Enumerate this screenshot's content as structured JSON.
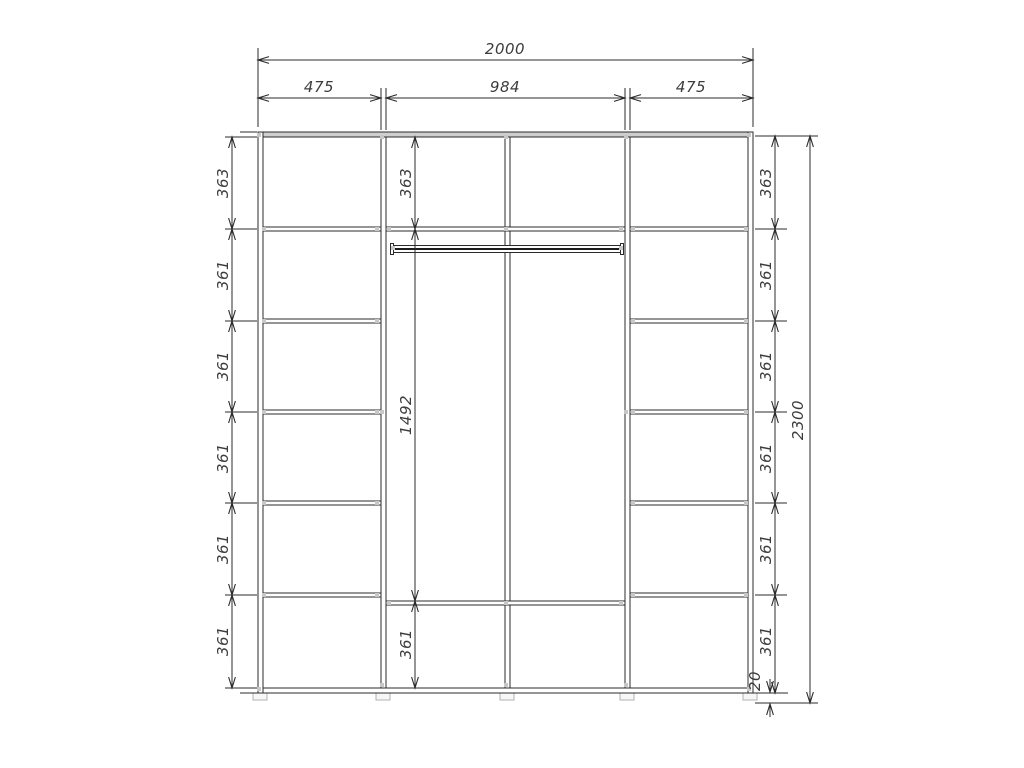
{
  "drawing": {
    "kind": "wardrobe-interior-dimension-drawing"
  },
  "colors": {
    "line": "#2b2b2b",
    "label": "#3c3c3c",
    "handle": "#c7c7c7",
    "top_panel_shade": "#cfcfcf",
    "background": "#ffffff"
  },
  "dimensions": {
    "overall_width": "2000",
    "top_sections": [
      "475",
      "984",
      "475"
    ],
    "left_column": [
      "363",
      "361",
      "361",
      "361",
      "361",
      "361"
    ],
    "center_column": [
      "363",
      "1492",
      "361"
    ],
    "right_column": [
      "363",
      "361",
      "361",
      "361",
      "361",
      "361"
    ],
    "plinth_height": "20",
    "overall_height": "2300"
  }
}
